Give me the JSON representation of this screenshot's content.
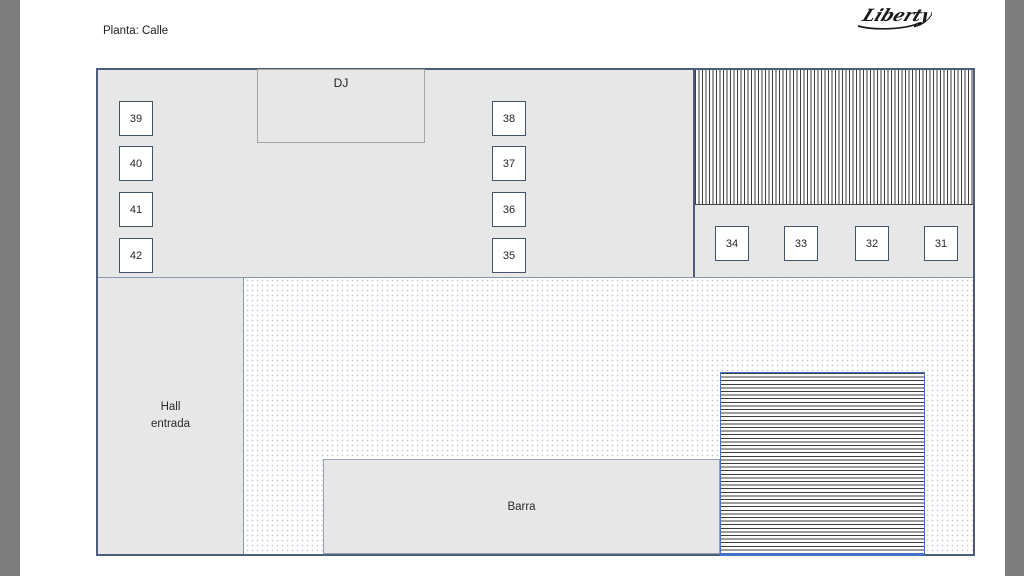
{
  "window": {
    "letterbox_color": "#7d7d7d"
  },
  "page": {
    "title": "Planta: Calle",
    "logo_text": "Liberty"
  },
  "plan": {
    "dj_label": "DJ",
    "hall_label_line1": "Hall",
    "hall_label_line2": "entrada",
    "barra_label": "Barra",
    "tables": {
      "left_column": [
        "39",
        "40",
        "41",
        "42"
      ],
      "middle_column": [
        "38",
        "37",
        "36",
        "35"
      ],
      "right_row": [
        "34",
        "33",
        "32",
        "31"
      ]
    },
    "colors": {
      "room_fill": "#e8e7e7",
      "outline_dark": "#44546a",
      "outline_light": "#a6a6a6",
      "stairs_accent": "#4472c4",
      "hatch_line": "#3d3d3d",
      "dot_pattern": "#c5c8d4"
    }
  }
}
